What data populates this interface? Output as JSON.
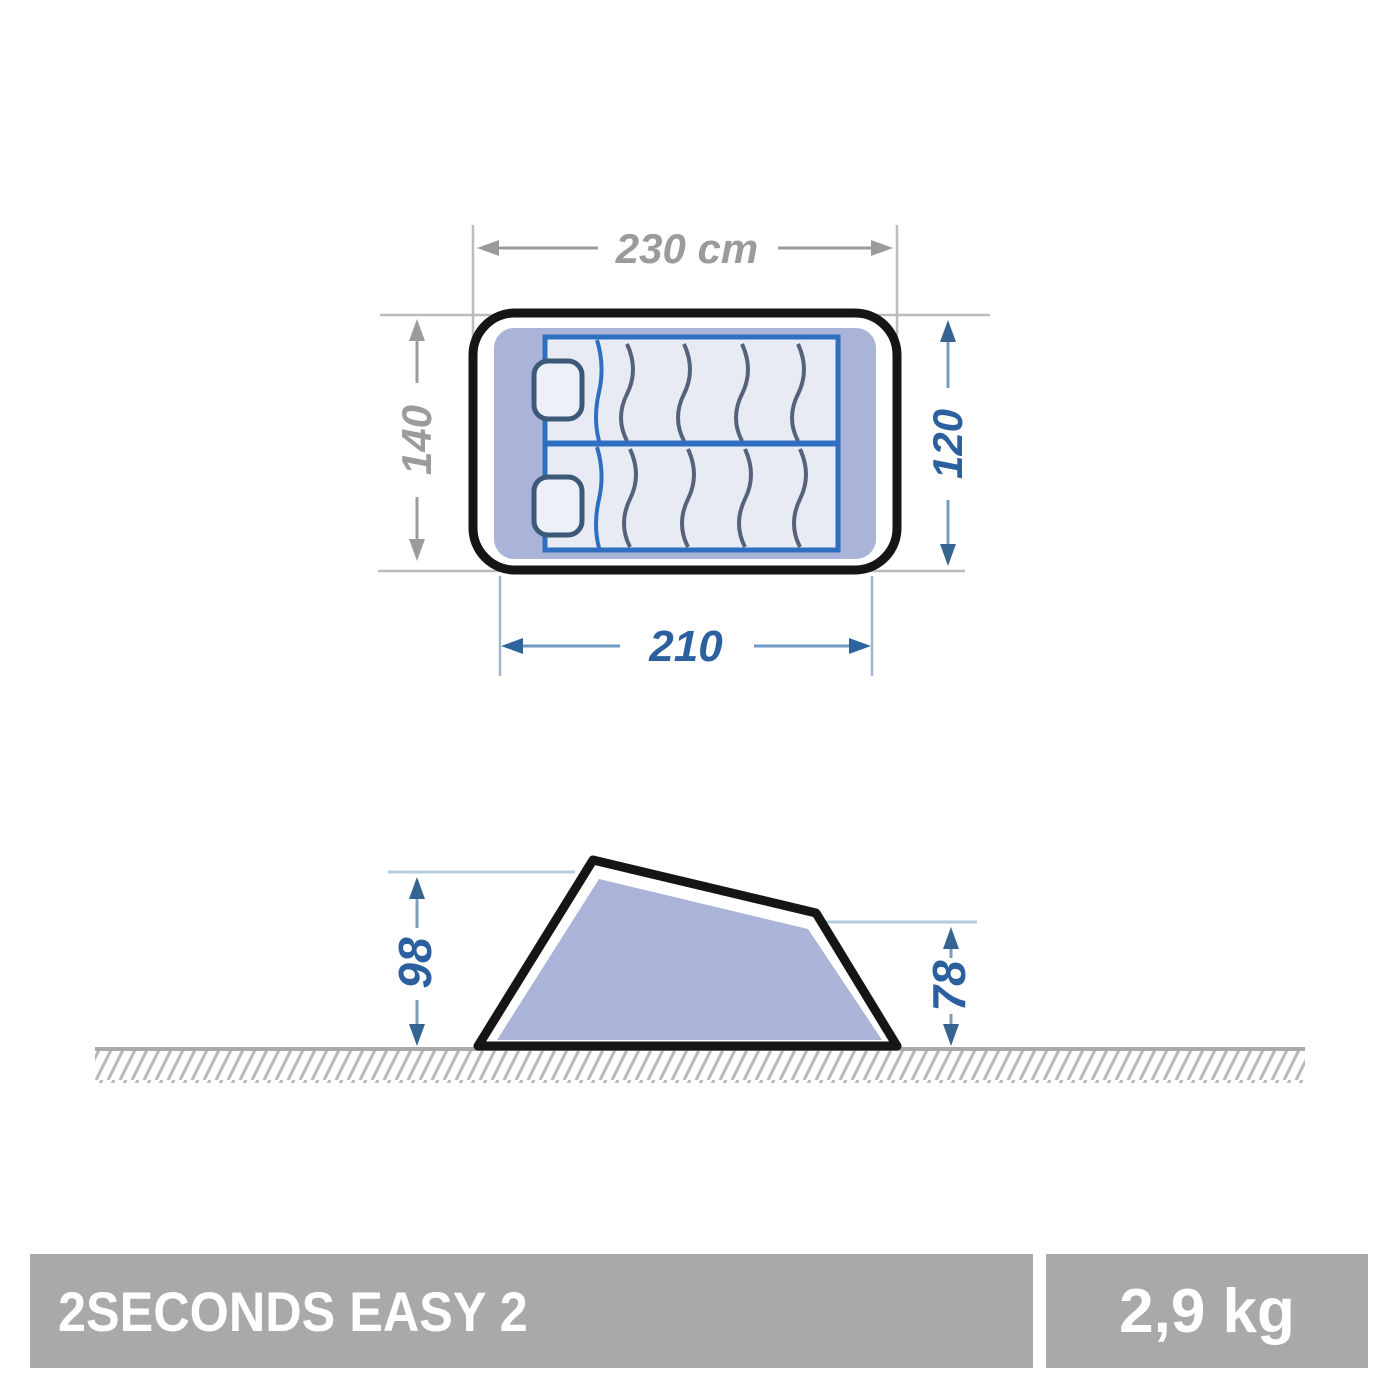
{
  "top_view": {
    "outer_width_label": "230 cm",
    "outer_depth_label": "140",
    "inner_depth_label": "120",
    "inner_width_label": "210"
  },
  "side_view": {
    "front_height_label": "98",
    "rear_height_label": "78"
  },
  "footer": {
    "product_name": "2SECONDS EASY 2",
    "weight": "2,9 kg"
  },
  "colors": {
    "dimension_gray": "#9b9b9b",
    "extension_gray": "#bcbcbc",
    "dimension_blue_text": "#2b5f9e",
    "dimension_blue_line": "#7b9cbd",
    "dimension_blue_arrow": "#34648f",
    "extension_light_blue": "#b5cddd",
    "tent_fill_periwinkle": "#a9b4d8",
    "outline_black": "#151515",
    "mattress_border_blue": "#2f6fc1",
    "mattress_fill": "#e9ebf4",
    "pillow_outline": "#3c5a77",
    "wave_line": "#55627c",
    "ground_gray": "#a9a9a9",
    "hatch_gray": "#b8b8b8",
    "footer_bar_gray": "#a9a9a9",
    "footer_text": "#ffffff"
  }
}
